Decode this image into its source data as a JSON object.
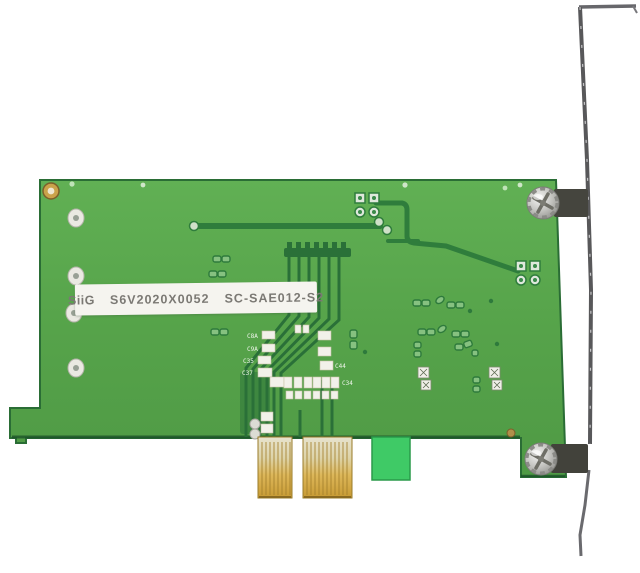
{
  "product_label": {
    "brand": "SiiG",
    "serial": "S6V2020X0052",
    "model": "SC-SAE012-S2"
  },
  "silkscreen": {
    "c1": "C8A",
    "c2": "C9A",
    "c3": "C35",
    "c4": "C37",
    "c5": "C44",
    "c6": "C34"
  },
  "colors": {
    "pcb_green": "#56a34a",
    "pcb_edge": "#2a6d35",
    "trace_dark_green": "#2f7d3c",
    "retention_tab_green": "#3fca66",
    "gold_finger": "#c79a33",
    "bracket_grey": "#5a5a5c",
    "screw_silver": "#c9c9c9",
    "label_background": "#f5f4ef",
    "label_text": "#7b7974",
    "photo_background": "#ffffff"
  }
}
